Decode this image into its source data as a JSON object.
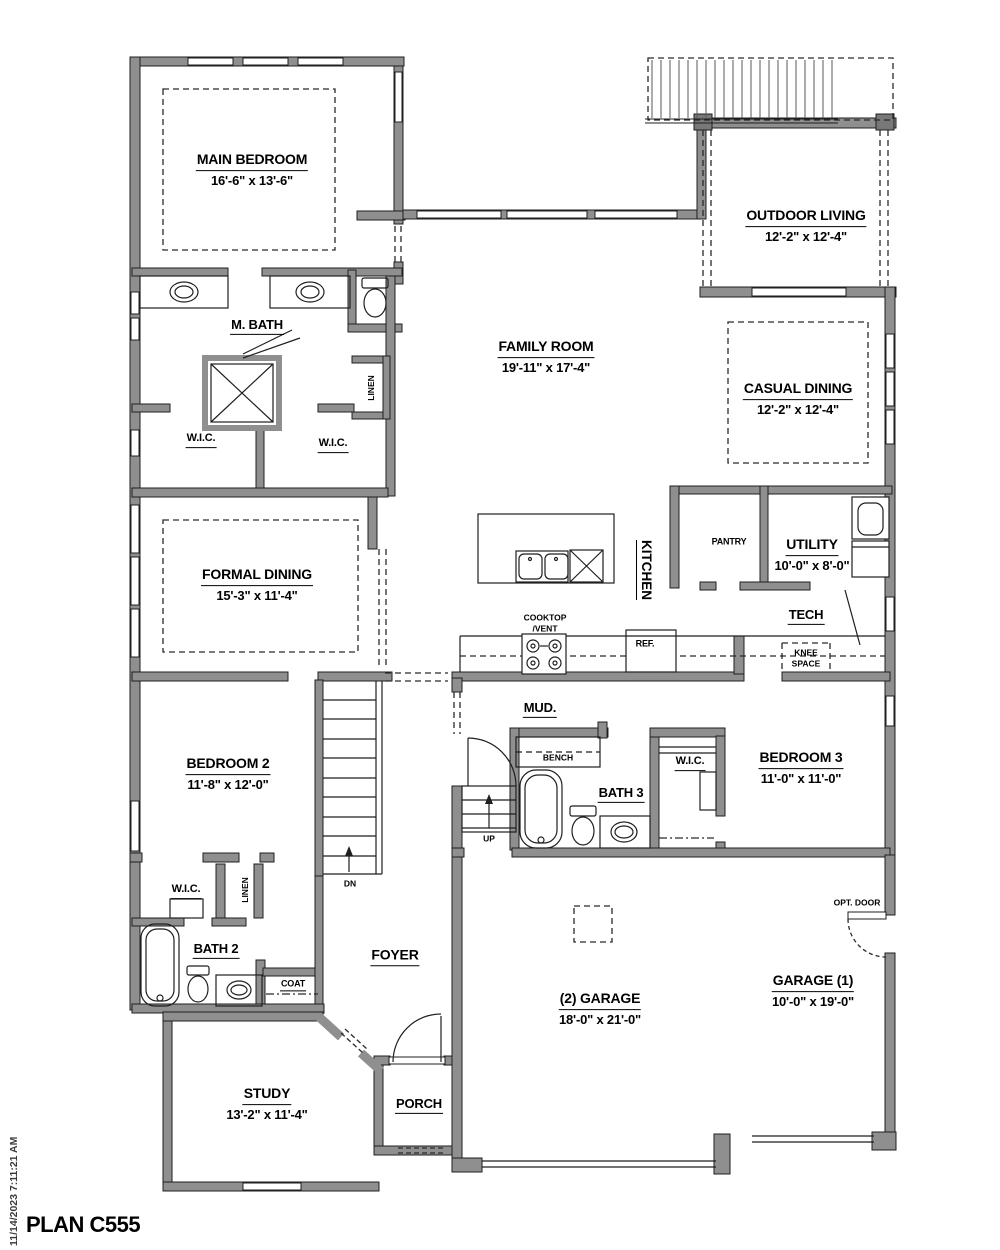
{
  "plan": {
    "title": "PLAN C555",
    "timestamp": "11/14/2023 7:11:21 AM"
  },
  "rooms": {
    "main_bedroom": {
      "name": "MAIN BEDROOM",
      "dims": "16'-6\" x 13'-6\""
    },
    "outdoor_living": {
      "name": "OUTDOOR LIVING",
      "dims": "12'-2\" x 12'-4\""
    },
    "family_room": {
      "name": "FAMILY ROOM",
      "dims": "19'-11\" x 17'-4\""
    },
    "casual_dining": {
      "name": "CASUAL DINING",
      "dims": "12'-2\" x 12'-4\""
    },
    "formal_dining": {
      "name": "FORMAL DINING",
      "dims": "15'-3\" x 11'-4\""
    },
    "m_bath": {
      "name": "M. BATH"
    },
    "wic_master_left": {
      "name": "W.I.C."
    },
    "wic_master_right": {
      "name": "W.I.C."
    },
    "linen_master": {
      "name": "LINEN"
    },
    "kitchen": {
      "name": "KITCHEN"
    },
    "pantry": {
      "name": "PANTRY"
    },
    "utility": {
      "name": "UTILITY",
      "dims": "10'-0\" x 8'-0\""
    },
    "tech": {
      "name": "TECH"
    },
    "knee_space": {
      "line1": "KNEE",
      "line2": "SPACE"
    },
    "cooktop": {
      "line1": "COOKTOP",
      "line2": "/VENT"
    },
    "ref": {
      "name": "REF."
    },
    "mud": {
      "name": "MUD."
    },
    "bench": {
      "name": "BENCH"
    },
    "bath3": {
      "name": "BATH 3"
    },
    "wic_bed3": {
      "name": "W.I.C."
    },
    "bedroom3": {
      "name": "BEDROOM 3",
      "dims": "11'-0\" x 11'-0\""
    },
    "bedroom2": {
      "name": "BEDROOM 2",
      "dims": "11'-8\" x 12'-0\""
    },
    "wic_bed2": {
      "name": "W.I.C."
    },
    "linen_bed2": {
      "name": "LINEN"
    },
    "bath2": {
      "name": "BATH 2"
    },
    "coat": {
      "name": "COAT"
    },
    "foyer": {
      "name": "FOYER"
    },
    "study": {
      "name": "STUDY",
      "dims": "13'-2\" x 11'-4\""
    },
    "porch": {
      "name": "PORCH"
    },
    "garage2": {
      "name": "(2) GARAGE",
      "dims": "18'-0\" x 21'-0\""
    },
    "garage1": {
      "name": "GARAGE (1)",
      "dims": "10'-0\" x 19'-0\""
    },
    "opt_door": {
      "name": "OPT. DOOR"
    },
    "stairs": {
      "up": "UP",
      "dn": "DN"
    }
  },
  "colors": {
    "wall": "#8f8f8f",
    "line": "#1f1f1f",
    "text": "#000000"
  }
}
